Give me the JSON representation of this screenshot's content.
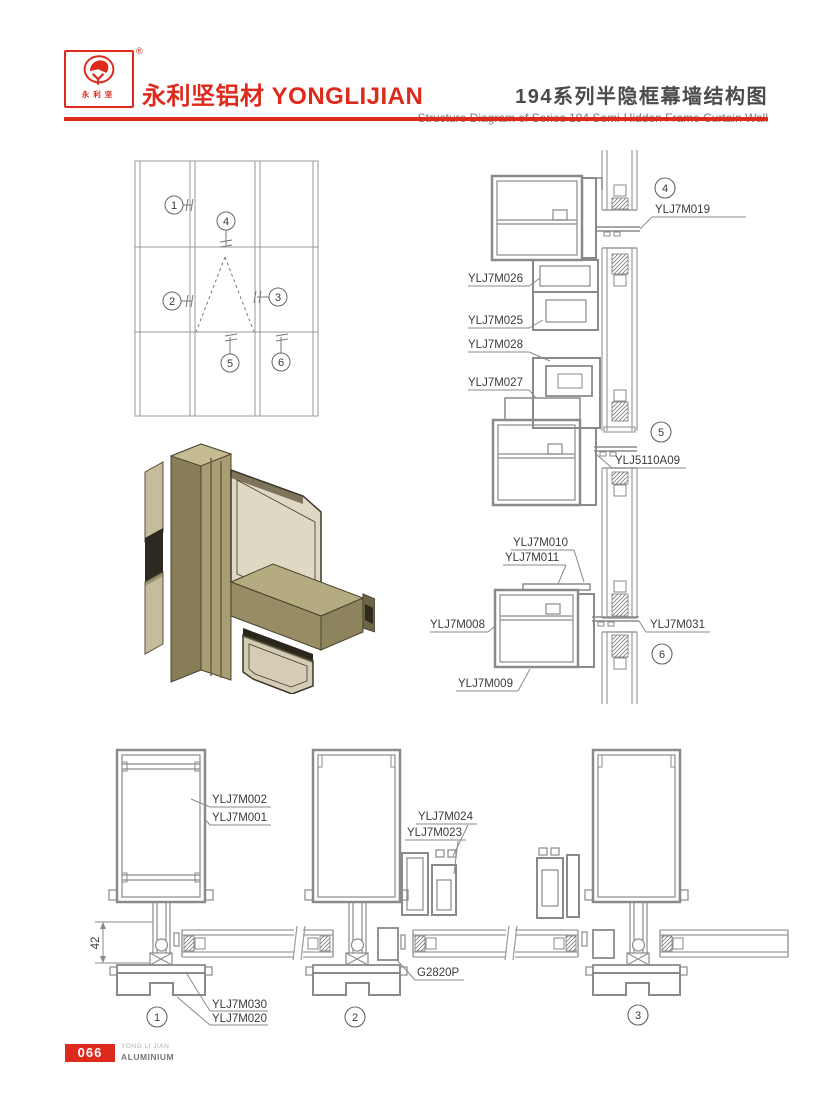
{
  "header": {
    "logo": {
      "text_chars": "永利坚",
      "registered": "®"
    },
    "brand": "永利坚铝材 YONGLIJIAN",
    "title_cn": "194系列半隐框幕墙结构图",
    "title_en": "Structure Diagram of Series 194 Semi-Hidden Frame Curtain Wall"
  },
  "elevation": {
    "callouts": [
      "1",
      "2",
      "3",
      "4",
      "5",
      "6"
    ]
  },
  "right_details": {
    "callouts": [
      "4",
      "5",
      "6"
    ],
    "parts": {
      "m019": "YLJ7M019",
      "m026": "YLJ7M026",
      "m025": "YLJ7M025",
      "m028": "YLJ7M028",
      "m027": "YLJ7M027",
      "a5110": "YLJ5110A09",
      "m010": "YLJ7M010",
      "m011": "YLJ7M011",
      "m008": "YLJ7M008",
      "m031": "YLJ7M031",
      "m009": "YLJ7M009"
    }
  },
  "bottom_details": {
    "callouts": [
      "1",
      "2",
      "3"
    ],
    "dim_height": "42",
    "parts": {
      "m002": "YLJ7M002",
      "m001": "YLJ7M001",
      "m024": "YLJ7M024",
      "m023": "YLJ7M023",
      "g2820p": "G2820P",
      "m030": "YLJ7M030",
      "m020": "YLJ7M020"
    }
  },
  "footer": {
    "page_number": "066",
    "brand_small_top": "YONG LI JIAN",
    "brand_small_bottom": "ALUMINIUM"
  },
  "colors": {
    "accent_red": "#dd2a1c",
    "drawing_gray": "#8a8a8a",
    "label_dark": "#3b3b3d"
  }
}
